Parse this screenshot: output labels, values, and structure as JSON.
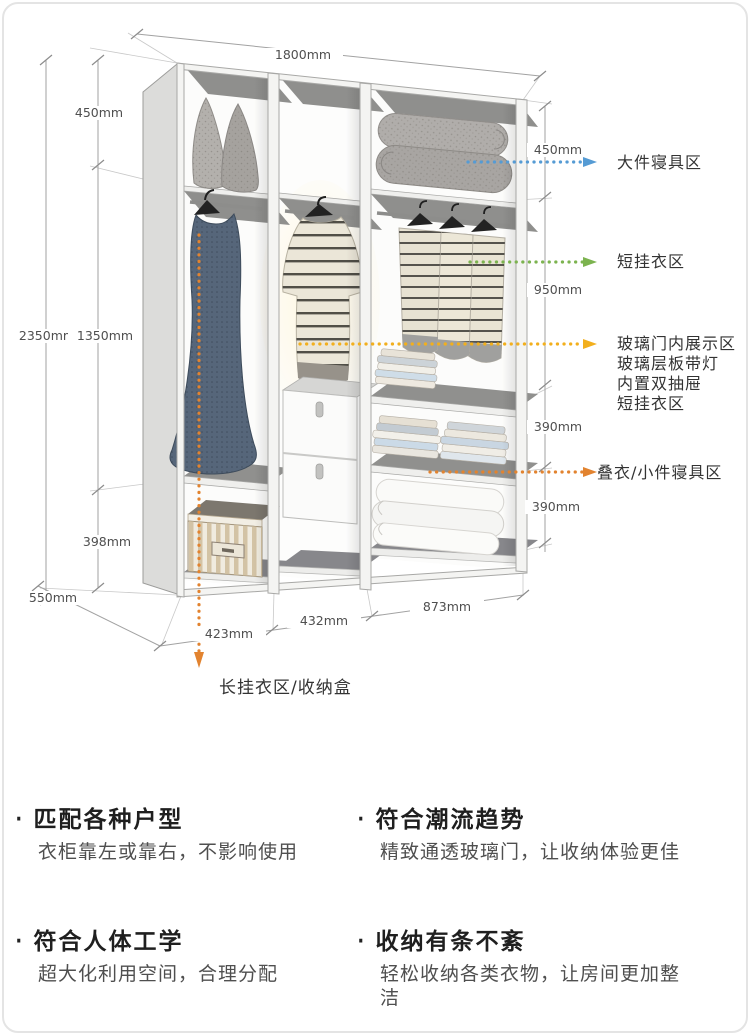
{
  "diagram": {
    "dims": {
      "top_width": "1800mm",
      "left_top": "450mm",
      "left_total": "2350mm",
      "left_mid": "1350mm",
      "left_bottom": "398mm",
      "depth": "550mm",
      "right_top": "450mm",
      "right_mid": "950mm",
      "right_low1": "390mm",
      "right_low2": "390mm",
      "bottom_col1": "423mm",
      "bottom_col2": "432mm",
      "bottom_col3": "873mm"
    },
    "zones": {
      "bedding_large": {
        "label": "大件寝具区",
        "color": "#559bd4"
      },
      "short_hanging": {
        "label": "短挂衣区",
        "color": "#7cb34f"
      },
      "glass_display": {
        "lines": [
          "玻璃门内展示区",
          "玻璃层板带灯",
          "内置双抽屉",
          "短挂衣区"
        ],
        "color": "#f2af1d"
      },
      "folded": {
        "label": "叠衣/小件寝具区",
        "color": "#e2832f"
      },
      "long_hanging": {
        "label": "长挂衣区/收纳盒",
        "color": "#e2832f"
      }
    }
  },
  "features_meta": {
    "bullet": "·"
  },
  "features": [
    {
      "title": "匹配各种户型",
      "desc": "衣柜靠左或靠右，不影响使用"
    },
    {
      "title": "符合潮流趋势",
      "desc": "精致通透玻璃门，让收纳体验更佳"
    },
    {
      "title": "符合人体工学",
      "desc": "超大化利用空间，合理分配"
    },
    {
      "title": "收纳有条不紊",
      "desc": "轻松收纳各类衣物，让房间更加整洁"
    }
  ]
}
